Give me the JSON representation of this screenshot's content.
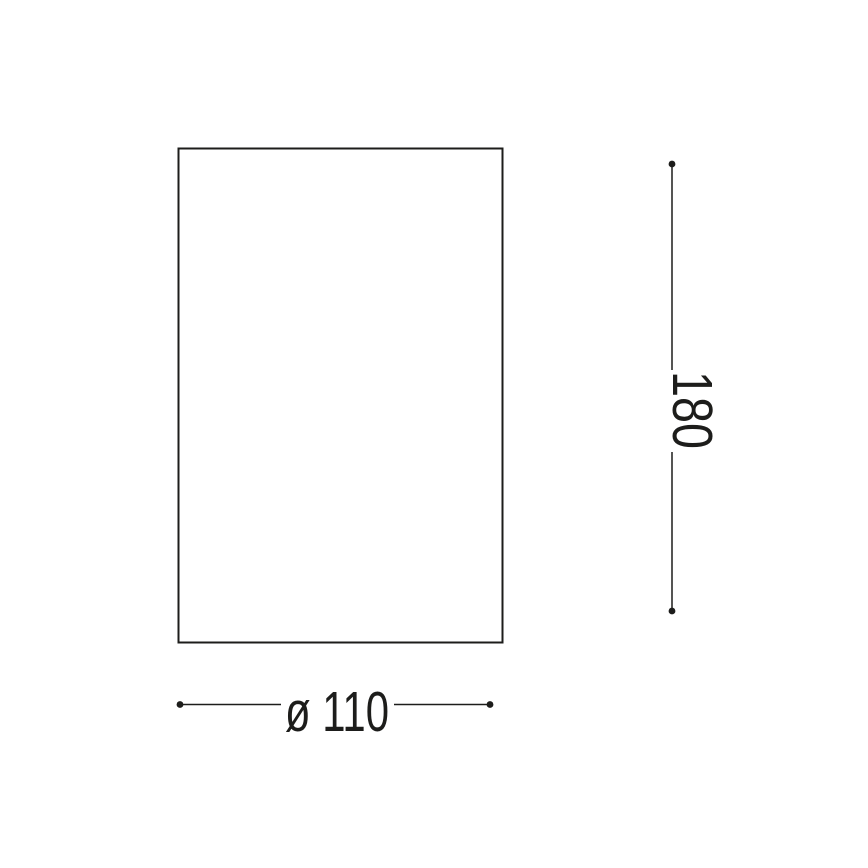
{
  "drawing": {
    "type": "technical-dimension-diagram",
    "background_color": "#ffffff",
    "line_color": "#1d1d1b",
    "text_color": "#1d1d1b",
    "outline_shape": "rectangle",
    "dimensions": {
      "width": {
        "label": "ø 110"
      },
      "height": {
        "label": "180"
      }
    }
  }
}
